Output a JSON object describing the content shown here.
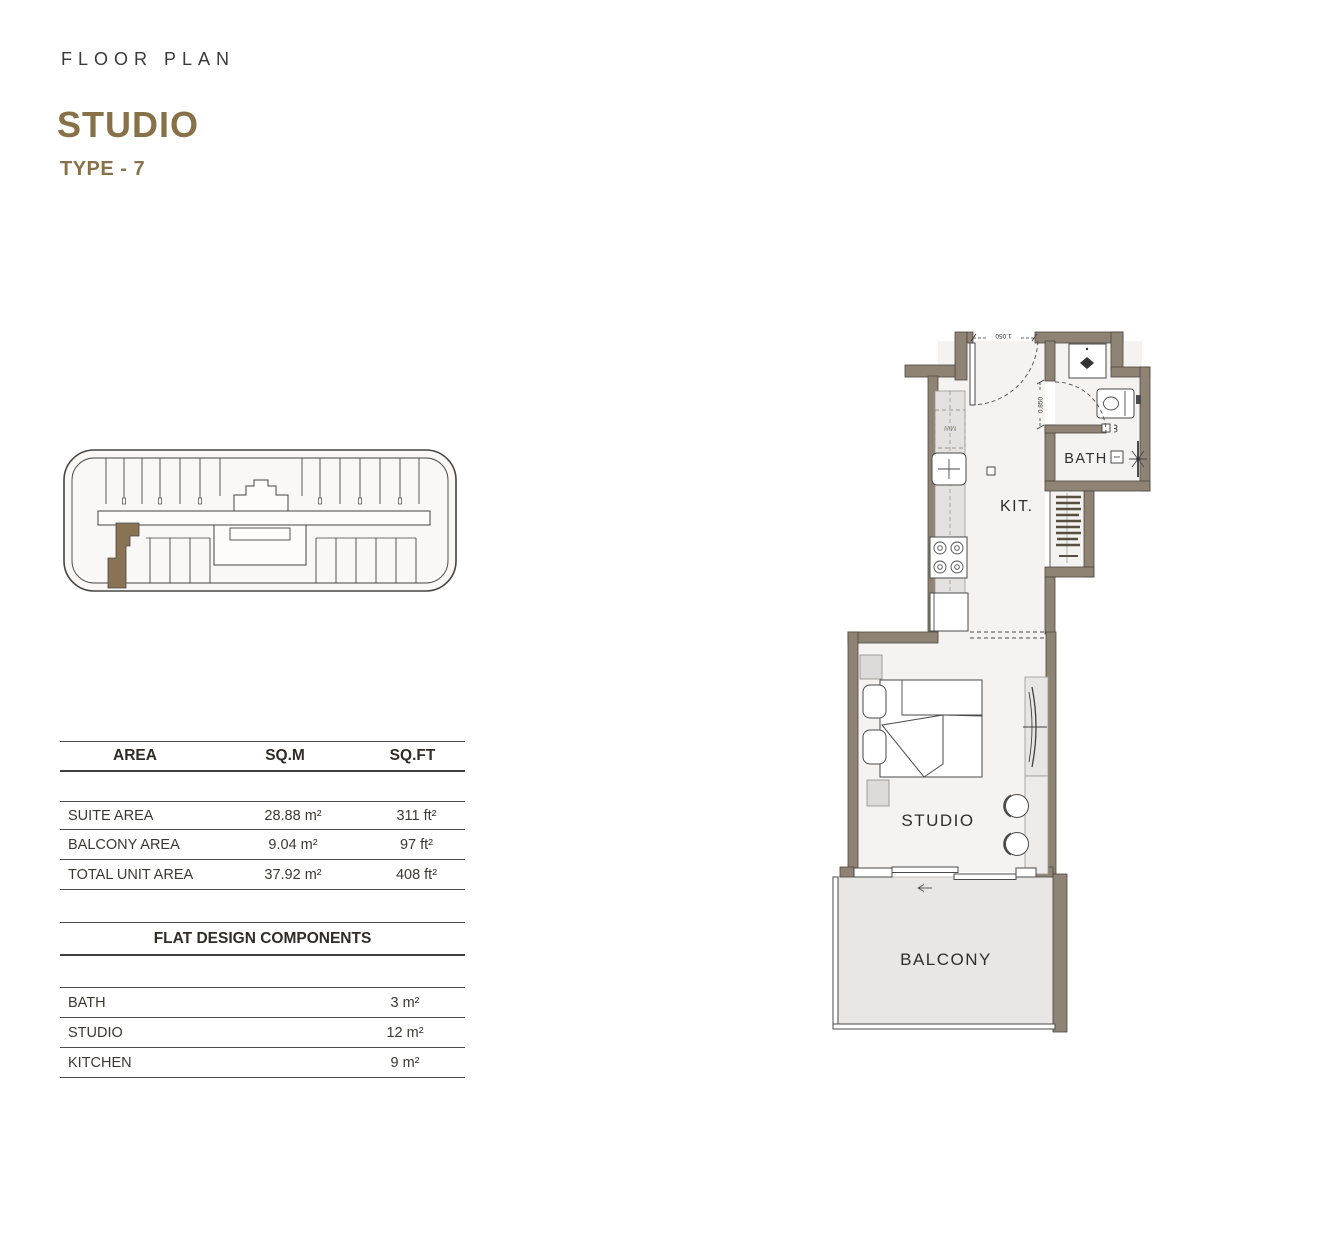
{
  "header": {
    "eyebrow": "FLOOR PLAN",
    "title": "STUDIO",
    "subtitle": "TYPE - 7",
    "accent_color": "#877149"
  },
  "key_plan": {
    "highlight_color": "#8a7355"
  },
  "area_table": {
    "columns": [
      "AREA",
      "SQ.M",
      "SQ.FT"
    ],
    "rows": [
      {
        "label": "SUITE AREA",
        "sqm": "28.88 m²",
        "sqft": "311 ft²"
      },
      {
        "label": "BALCONY AREA",
        "sqm": "9.04 m²",
        "sqft": "97 ft²"
      },
      {
        "label": "TOTAL UNIT AREA",
        "sqm": "37.92 m²",
        "sqft": "408 ft²"
      }
    ]
  },
  "components_table": {
    "title": "FLAT DESIGN COMPONENTS",
    "rows": [
      {
        "label": "BATH",
        "value": "3 m²"
      },
      {
        "label": "STUDIO",
        "value": "12 m²"
      },
      {
        "label": "KITCHEN",
        "value": "9 m²"
      }
    ]
  },
  "floor_plan": {
    "rooms": {
      "kitchen": "KIT.",
      "bath": "BATH",
      "studio": "STUDIO",
      "balcony": "BALCONY"
    },
    "appliances": {
      "microwave": "MW"
    },
    "dimensions": {
      "entrance": "1.050",
      "bath_door": "0.850"
    },
    "colors": {
      "wall": "#8e8375",
      "floor": "#f4f3f1",
      "balcony_floor": "#e8e7e5"
    }
  }
}
